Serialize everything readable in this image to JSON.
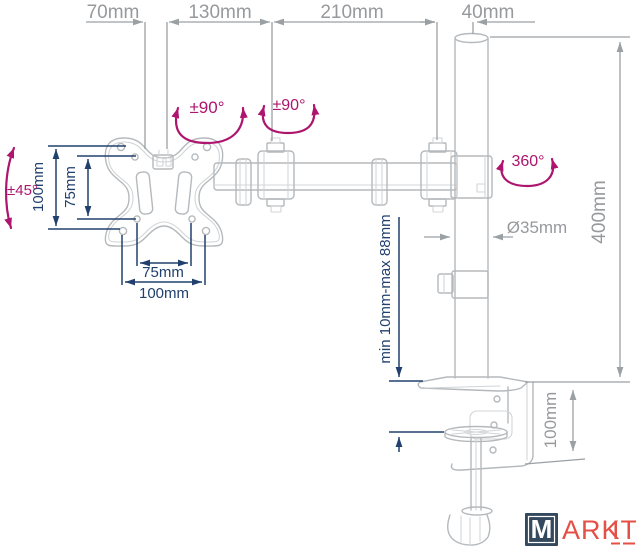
{
  "title": "Monitor desk mount arm dimensional diagram",
  "colors": {
    "dimension_gray": "#9aa0a3",
    "dimension_blue": "#21406e",
    "rotation_magenta": "#ad156e",
    "drawing_outline": "#b5b9bc",
    "logo_box": "#34495e",
    "logo_text": "#e44f46"
  },
  "dims": {
    "top_offset": "70mm",
    "arm_front": "130mm",
    "arm_rear": "210mm",
    "pole_offset": "40mm",
    "vesa_height_outer": "100mm",
    "vesa_height_inner": "75mm",
    "vesa_width_inner": "75mm",
    "vesa_width_outer": "100mm",
    "pole_diameter": "Ø35mm",
    "pole_height": "400mm",
    "clamp_range": "min 10mm-max 88mm",
    "clamp_depth": "100mm"
  },
  "rotations": {
    "tilt": "±45°",
    "joint_front": "±90°",
    "joint_rear": "±90°",
    "pole_swivel": "360°"
  },
  "logo": {
    "m": "M",
    "ark": "ARK",
    "it": "IT"
  }
}
